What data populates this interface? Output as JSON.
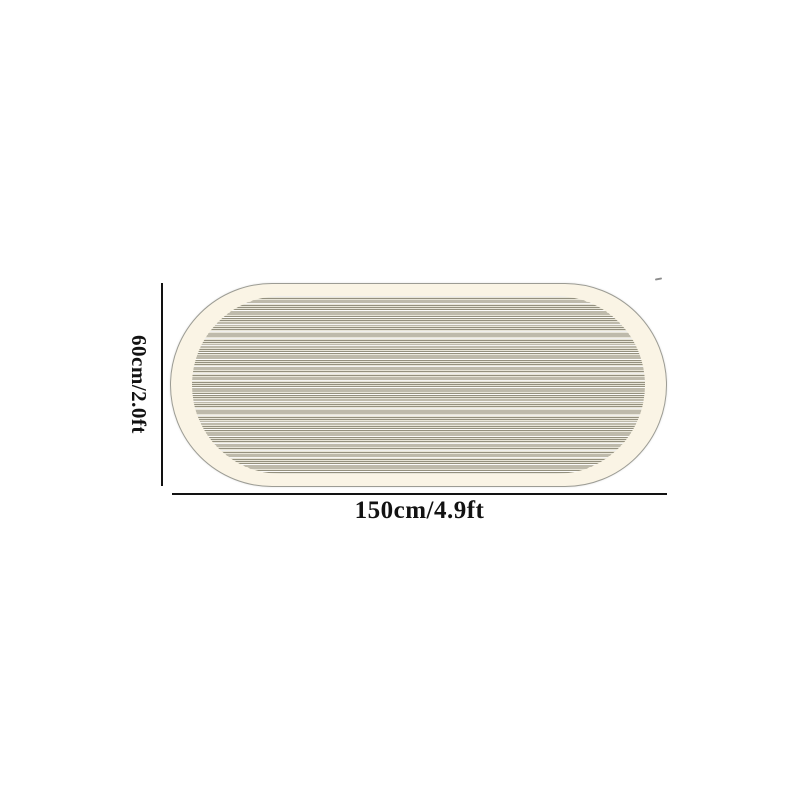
{
  "diagram": {
    "name": "rug-size-diagram",
    "subject": "oval-striped-rug",
    "height_label": "60cm/2.0ft",
    "width_label": "150cm/4.9ft",
    "colors": {
      "bg": "#ffffff",
      "rug_base": "#faf4e5",
      "rug_outline": "#9c9c94",
      "stripe_dark": "#94907e",
      "stripe_light": "#e8e5d8",
      "stripe_highlight": "#ffffff",
      "dimension": "#121212"
    }
  }
}
